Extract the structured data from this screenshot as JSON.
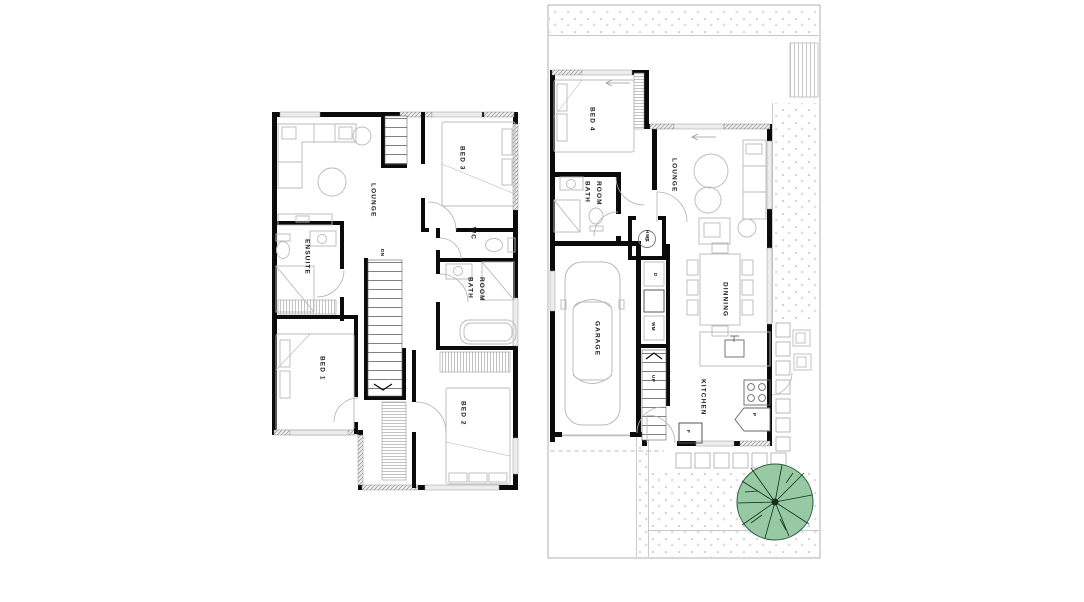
{
  "document": {
    "type": "two-storey house floor plan drawing",
    "floors": 2
  },
  "palette": {
    "wall": "#0b0b0b",
    "window_fill": "#ededed",
    "furniture_line": "#b9b9b9",
    "site_line": "#9aa0a6",
    "tree_fill": "#96c9a4",
    "tree_outline": "#2a5c39",
    "dot": "#c4c4cc"
  },
  "upper_floor": {
    "labels": {
      "lounge": "LOUNGE",
      "bed3": "BED 3",
      "ensuite": "ENSUITE",
      "wc": "WC",
      "bath_room": "BATH ROOM",
      "stairs_down": "DN",
      "bed1": "BED 1",
      "bed2": "BED 2"
    }
  },
  "ground_floor": {
    "labels": {
      "bed4": "BED 4",
      "bath_room": "BATH ROOM",
      "lounge": "LOUNGE",
      "hot_water_cupboard": "HWC",
      "dryer": "D",
      "washing_machine": "WM",
      "garage": "GARAGE",
      "stairs_up": "UP",
      "dining": "DINNING",
      "kitchen": "KITCHEN",
      "pantry": "P",
      "fridge": "F"
    }
  }
}
